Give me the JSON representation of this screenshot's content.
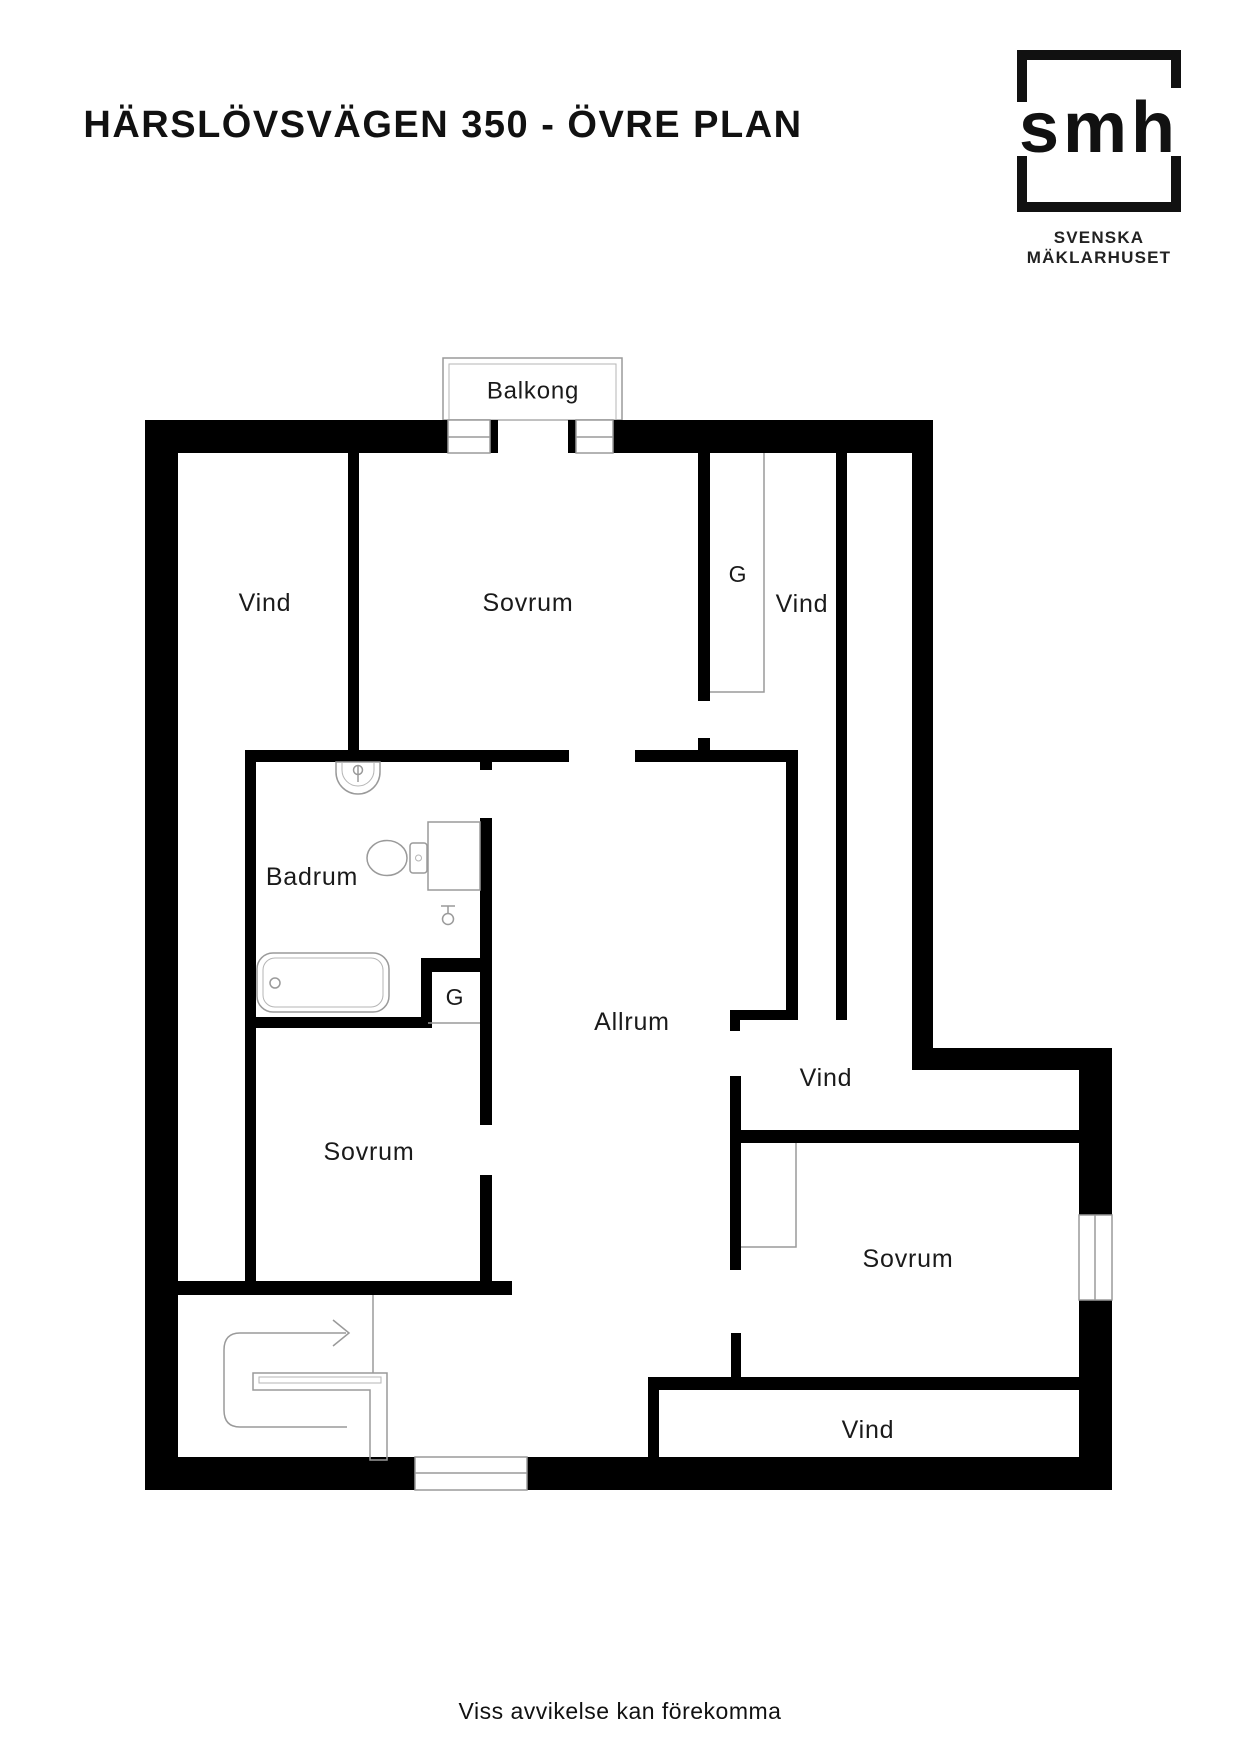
{
  "header": {
    "title": "HÄRSLÖVSVÄGEN 350 - ÖVRE PLAN",
    "logo": {
      "mark": "smh",
      "line1": "SVENSKA",
      "line2": "MÄKLARHUSET"
    }
  },
  "floorplan": {
    "rooms": [
      {
        "id": "balkong",
        "label": "Balkong",
        "x": 533,
        "y": 391,
        "size": 24
      },
      {
        "id": "vind-top-left",
        "label": "Vind",
        "x": 265,
        "y": 603,
        "size": 25
      },
      {
        "id": "sovrum-top",
        "label": "Sovrum",
        "x": 528,
        "y": 603,
        "size": 25
      },
      {
        "id": "garderob-top",
        "label": "G",
        "x": 738,
        "y": 574,
        "size": 23
      },
      {
        "id": "vind-top-right",
        "label": "Vind",
        "x": 802,
        "y": 604,
        "size": 25
      },
      {
        "id": "badrum",
        "label": "Badrum",
        "x": 312,
        "y": 877,
        "size": 25
      },
      {
        "id": "garderob-bad",
        "label": "G",
        "x": 455,
        "y": 997,
        "size": 23
      },
      {
        "id": "allrum",
        "label": "Allrum",
        "x": 632,
        "y": 1022,
        "size": 25
      },
      {
        "id": "vind-mid-right",
        "label": "Vind",
        "x": 826,
        "y": 1078,
        "size": 25
      },
      {
        "id": "sovrum-left",
        "label": "Sovrum",
        "x": 369,
        "y": 1152,
        "size": 25
      },
      {
        "id": "sovrum-right",
        "label": "Sovrum",
        "x": 908,
        "y": 1259,
        "size": 25
      },
      {
        "id": "vind-bottom",
        "label": "Vind",
        "x": 868,
        "y": 1430,
        "size": 25
      }
    ],
    "icons": [
      "sink-icon",
      "toilet-icon",
      "bathtub-icon",
      "faucet-icon",
      "stairs-icon",
      "direction-arrow-icon"
    ],
    "colors": {
      "wall": "#000000",
      "fixture_line": "#9a9a9a",
      "label_text": "#1a1a1a"
    }
  },
  "footer": {
    "disclaimer": "Viss avvikelse kan förekomma"
  }
}
